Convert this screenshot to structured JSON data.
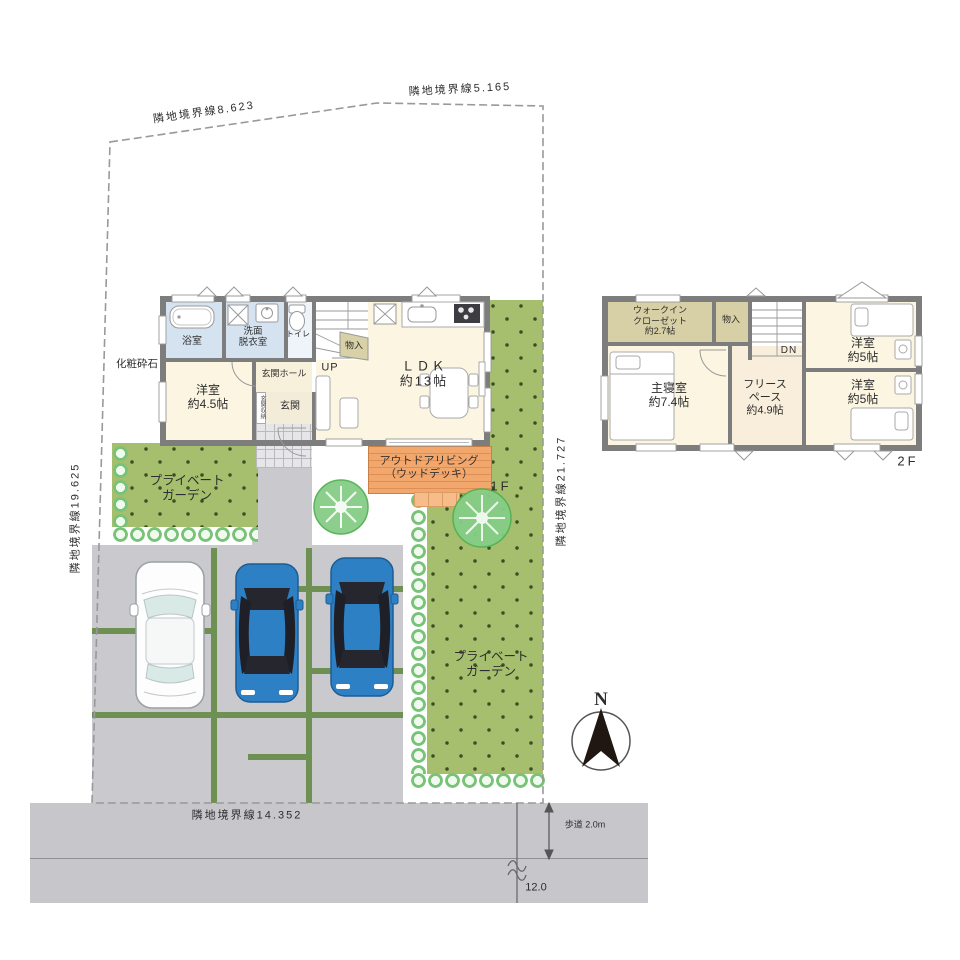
{
  "site": {
    "boundaries": {
      "top_left": "隣地境界線8.623",
      "top_right": "隣地境界線5.165",
      "left": "隣地境界線19.625",
      "right": "隣地境界線21.727",
      "bottom": "隣地境界線14.352"
    },
    "gravel_label": "化粧砕石",
    "garden_left_label": "プライベート\nガーデン",
    "garden_right_label": "プライベート\nガーデン",
    "road": {
      "sidewalk": "歩道 2.0m",
      "width": "12.0"
    },
    "compass_n": "N"
  },
  "floor1": {
    "floor_label": "1F",
    "bath": "浴室",
    "washroom": "洗面\n脱衣室",
    "toilet": "トイレ",
    "storage": "物入",
    "stairs_up": "UP",
    "ldk": "ＬＤＫ\n約13帖",
    "hall": "玄関ホール",
    "entrance": "玄関",
    "entrance_storage": "玄関収納",
    "bedroom": "洋室\n約4.5帖",
    "outdoor_living": "アウトドアリビング\n（ウッドデッキ）"
  },
  "floor2": {
    "floor_label": "2F",
    "wic": "ウォークイン\nクローゼット\n約2.7帖",
    "storage": "物入",
    "stairs_down": "DN",
    "master": "主寝室\n約7.4帖",
    "free_space": "フリース\nペース\n約4.9帖",
    "bedroom_top": "洋室\n約5帖",
    "bedroom_bottom": "洋室\n約5帖"
  },
  "colors": {
    "wall": "#7d7d7d",
    "floor_cream": "#fbf5e2",
    "floor_tan": "#d7cfa5",
    "floor_blue": "#d5e3f1",
    "garden_green": "#a5bf6e",
    "deck_orange": "#f0a266",
    "driveway_gray": "#c9c9ce",
    "road_gray": "#c6c6cb",
    "car_blue": "#2e80c4",
    "grass_strip": "#6e9052"
  }
}
